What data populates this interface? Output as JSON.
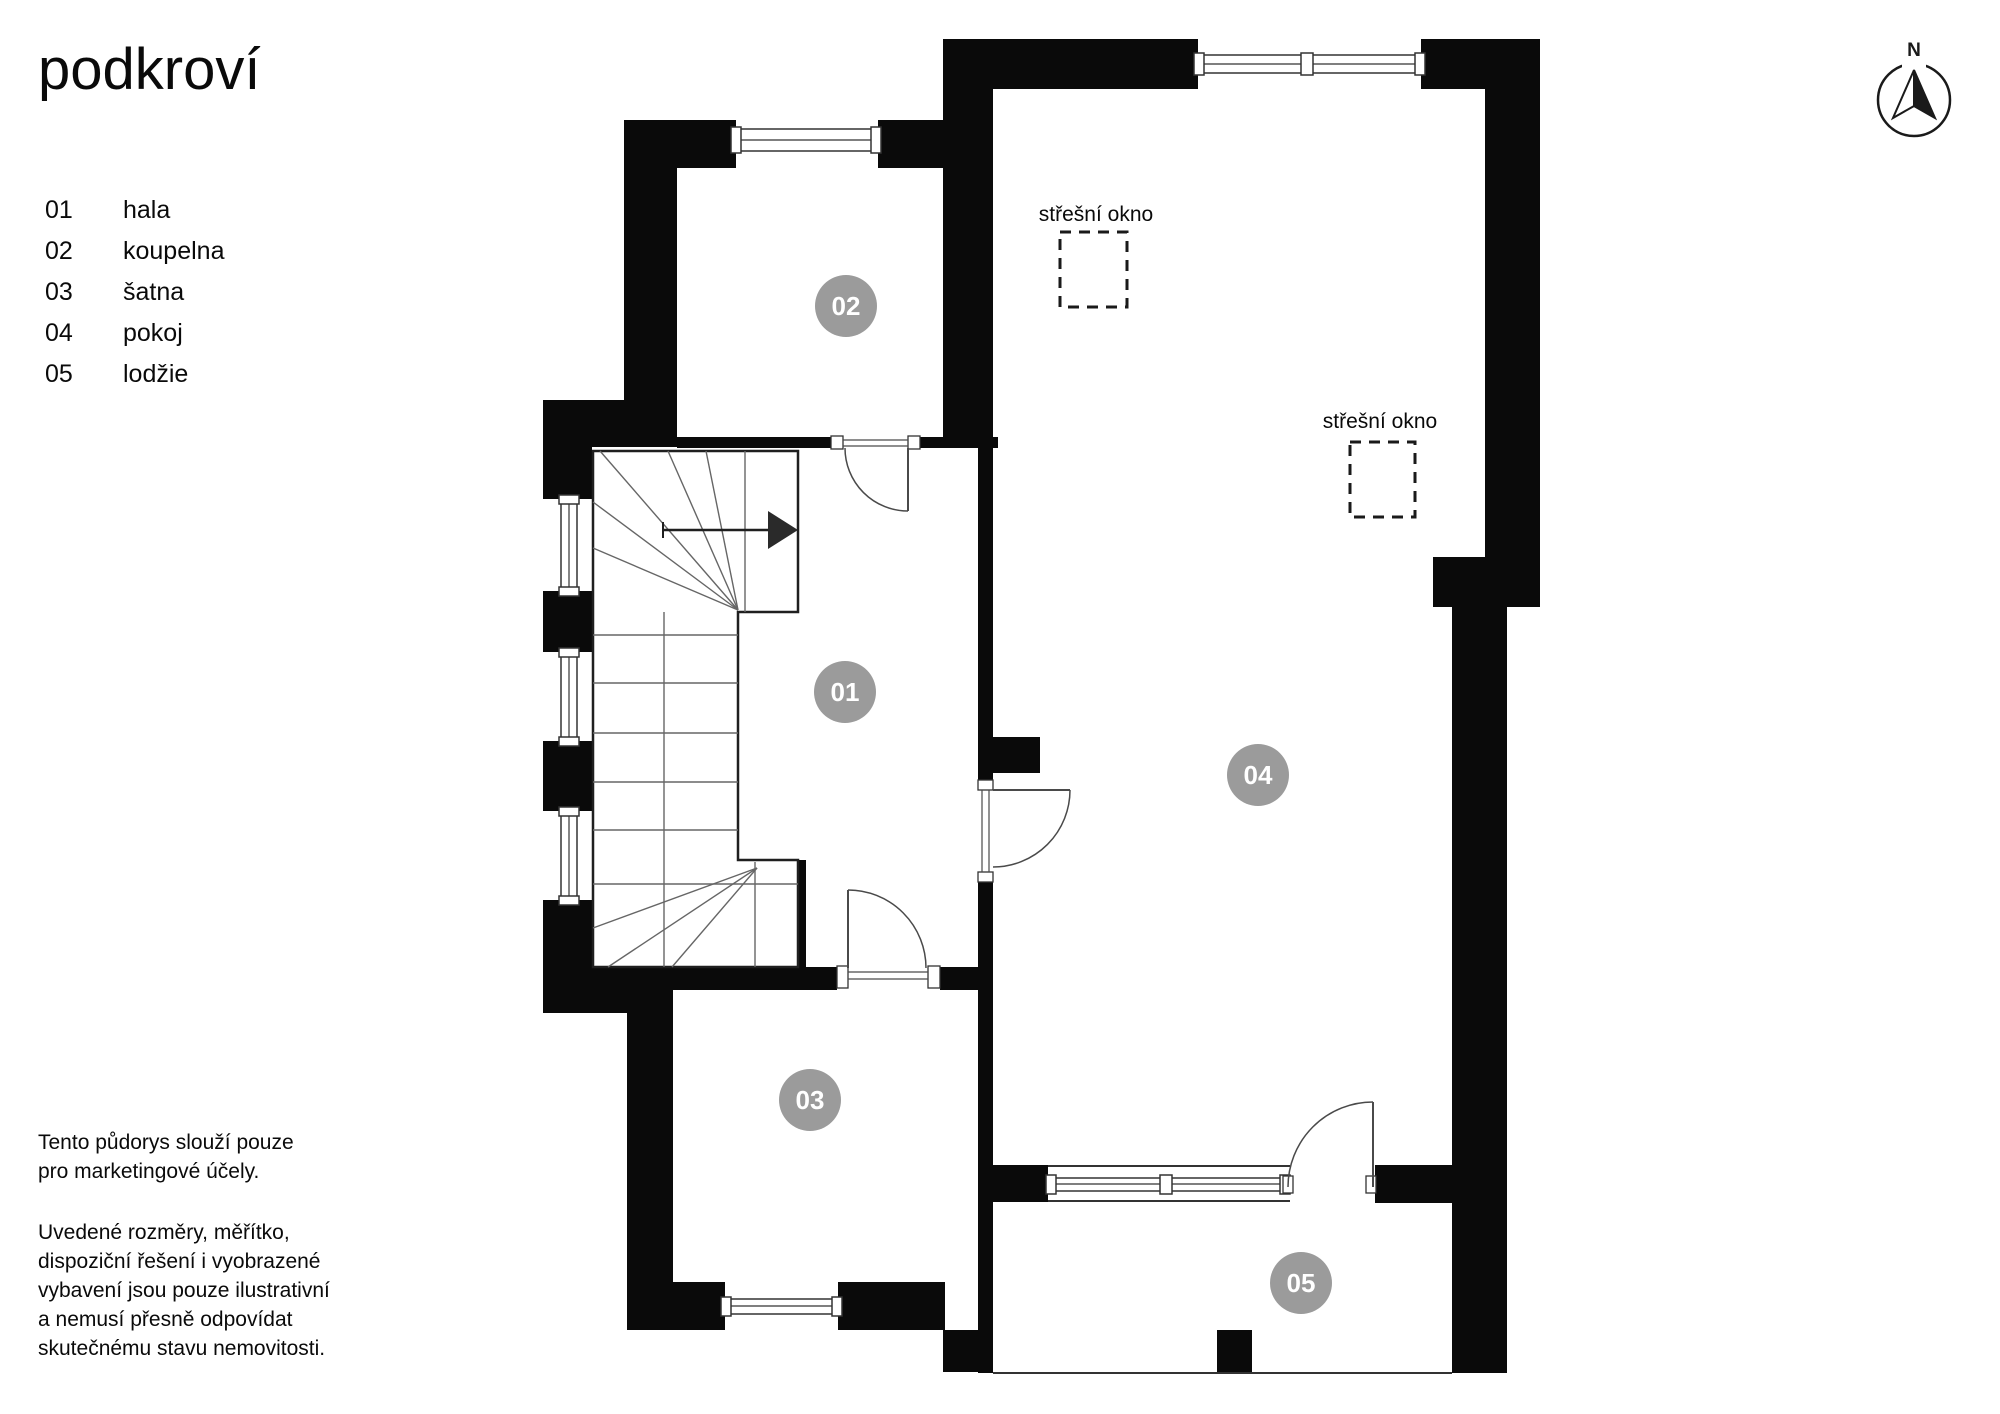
{
  "title": "podkroví",
  "legend": {
    "items": [
      {
        "num": "01",
        "label": "hala"
      },
      {
        "num": "02",
        "label": "koupelna"
      },
      {
        "num": "03",
        "label": "šatna"
      },
      {
        "num": "04",
        "label": "pokoj"
      },
      {
        "num": "05",
        "label": "lodžie"
      }
    ]
  },
  "disclaimer": {
    "para1": "Tento půdorys slouží pouze\npro marketingové účely.",
    "para2": "Uvedené rozměry, měřítko,\ndispoziční řešení i vyobrazené\nvybavení jsou pouze ilustrativní\na nemusí přesně odpovídat\nskutečnému stavu nemovitosti."
  },
  "compass": {
    "label": "N"
  },
  "plan": {
    "rooms": [
      {
        "id": "01"
      },
      {
        "id": "02"
      },
      {
        "id": "03"
      },
      {
        "id": "04"
      },
      {
        "id": "05"
      }
    ],
    "roof_windows": [
      {
        "label": "střešní okno"
      },
      {
        "label": "střešní okno"
      }
    ],
    "colors": {
      "wall": "#0a0a0a",
      "badge": "#9b9b9b"
    }
  }
}
